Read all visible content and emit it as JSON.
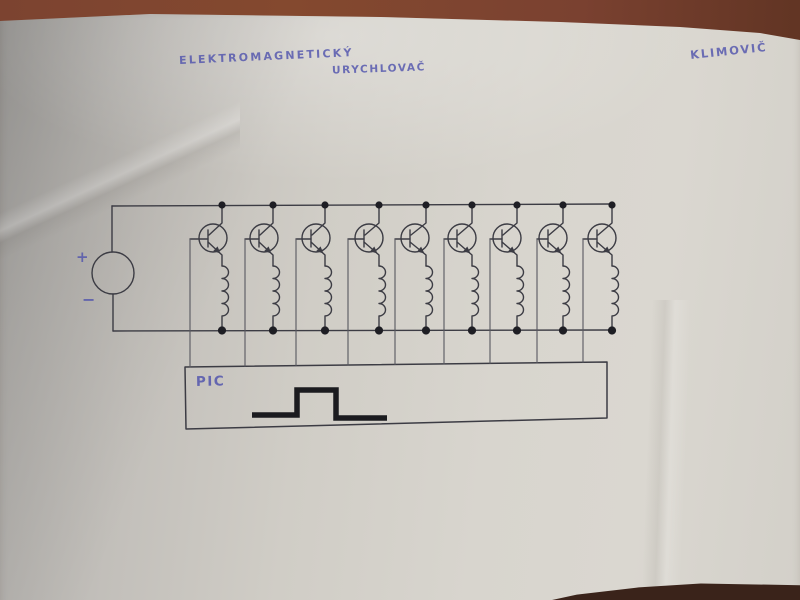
{
  "photo": {
    "table_color": "#7a4130",
    "paper_color": "#d4d1ca"
  },
  "annotations": {
    "title_line1": "ELEKTROMAGNETICKÝ",
    "title_line2": "URYCHLOVAČ",
    "author": "KLIMOVIČ",
    "ink_color": "#4f52ad"
  },
  "schematic": {
    "description": "Hand-drawn circuit: DC source driving nine transistor-coil stages, bases controlled by a PIC outputting a pulse",
    "stroke_color": "#3c3c44",
    "light_stroke_color": "#585860",
    "dot_color": "#1e1e24",
    "pulse_color": "#1b1b1f",
    "source": {
      "plus_label": "+",
      "minus_label": "−",
      "cx": 113,
      "cy": 273,
      "r": 21
    },
    "rails": {
      "top_y": 205,
      "bottom_y": 331,
      "left_x": 112,
      "right_x": 612
    },
    "transistor": {
      "cy": 238,
      "r": 14,
      "count": 9,
      "type": "NPN"
    },
    "coil": {
      "top_y": 266,
      "bump_r": 6.5,
      "bump_h": 12.5,
      "bumps": 4
    },
    "stages": [
      {
        "t": 213,
        "d": 222,
        "b": 190
      },
      {
        "t": 264,
        "d": 273,
        "b": 245
      },
      {
        "t": 316,
        "d": 325,
        "b": 296
      },
      {
        "t": 369,
        "d": 379,
        "b": 348
      },
      {
        "t": 415,
        "d": 426,
        "b": 395
      },
      {
        "t": 462,
        "d": 472,
        "b": 444
      },
      {
        "t": 507,
        "d": 517,
        "b": 490
      },
      {
        "t": 553,
        "d": 563,
        "b": 537
      },
      {
        "t": 602,
        "d": 612,
        "b": 583
      }
    ],
    "pic_box": {
      "label": "PIC",
      "points": [
        [
          185,
          367
        ],
        [
          607,
          362
        ],
        [
          607,
          418
        ],
        [
          186,
          429
        ]
      ]
    },
    "pulse_points": [
      [
        252,
        415
      ],
      [
        297,
        415
      ],
      [
        297,
        390
      ],
      [
        336,
        390
      ],
      [
        336,
        418
      ],
      [
        387,
        418
      ]
    ]
  }
}
